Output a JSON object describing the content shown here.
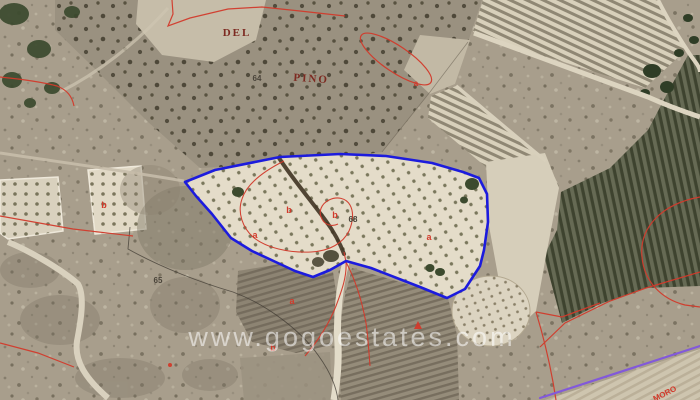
{
  "watermark": {
    "text": "www.gogoestates.com",
    "color": "rgba(255,255,255,0.55)"
  },
  "boundary": {
    "color": "#1c1bdd",
    "points": "185,182 215,170 280,157 340,154 386,156 432,163 463,172 479,178 487,194 488,222 484,250 480,266 465,289 447,298 420,287 371,268 346,261 330,270 313,277 295,271 280,264 252,251 231,238 212,214 196,196"
  },
  "cadastral": {
    "red_color": "#d23a2b",
    "purple_color": "#8259da",
    "paths": {
      "top_zigzag": "M172,0 L173,14 L168,26 L190,18 L228,9 L262,7 L300,11 L345,16",
      "left_curve": "M0,77 C20,79 42,82 57,86 C67,90 72,96 74,106",
      "mid_left_line": "M0,216 L73,229 L133,236",
      "bottom_left_line": "M0,343 L38,353 L74,367",
      "parcel_loop": "M284,161 C266,170 247,183 242,199 C237,213 243,228 253,237 C266,248 289,253 311,252 C330,251 343,243 349,231 C353,222 354,212 350,205 C346,198 337,196 329,200 C321,204 318,212 322,219 C325,225 332,227 338,224",
      "loop_tail_left": "M344,252 L346,262 C347,276 342,290 336,306 C329,324 317,342 305,356",
      "loop_tail_right": "M346,262 C356,281 362,301 366,323 C368,337 369,353 370,366",
      "right_arc": "M700,197 C661,204 639,228 642,257 C644,281 661,299 685,305 L700,307",
      "terrace_line": "M540,347 L565,323 L610,301 L646,288 L700,272",
      "terrace_corner": "M536,312 L562,317 L600,303",
      "terrace_down": "M536,312 C543,335 549,360 553,382 L556,400"
    },
    "oval": {
      "cx": 396,
      "cy": 59,
      "rx": 42,
      "ry": 13
    }
  },
  "purple_line": {
    "x1": 540,
    "y1": 398,
    "x2": 700,
    "y2": 346
  },
  "labels": [
    {
      "text": "DEL",
      "x": 237,
      "y": 36,
      "color": "#7d2a21",
      "size": 11
    },
    {
      "text": "PINO",
      "x": 311,
      "y": 82,
      "color": "#7d2a21",
      "size": 11
    },
    {
      "text": "64",
      "x": 257,
      "y": 81,
      "color": "#4a443a",
      "size": 8
    },
    {
      "text": "65",
      "x": 158,
      "y": 283,
      "color": "#4a443a",
      "size": 8
    },
    {
      "text": "68",
      "x": 353,
      "y": 222,
      "color": "#4a443a",
      "size": 8
    },
    {
      "text": "a",
      "x": 255,
      "y": 238,
      "color": "#d23a2b",
      "size": 9
    },
    {
      "text": "a",
      "x": 429,
      "y": 240,
      "color": "#d23a2b",
      "size": 9
    },
    {
      "text": "a",
      "x": 292,
      "y": 304,
      "color": "#d23a2b",
      "size": 9
    },
    {
      "text": "b",
      "x": 289,
      "y": 213,
      "color": "#d23a2b",
      "size": 9
    },
    {
      "text": "b",
      "x": 335,
      "y": 218,
      "color": "#d23a2b",
      "size": 9
    },
    {
      "text": "b",
      "x": 104,
      "y": 208,
      "color": "#d23a2b",
      "size": 9
    },
    {
      "text": "b",
      "x": 273,
      "y": 351,
      "color": "#d23a2b",
      "size": 9
    },
    {
      "text": "a",
      "x": 416,
      "y": 86,
      "color": "#d23a2b",
      "size": 8
    },
    {
      "text": "MORO",
      "x": 666,
      "y": 396,
      "color": "#d23a2b",
      "size": 8
    }
  ]
}
